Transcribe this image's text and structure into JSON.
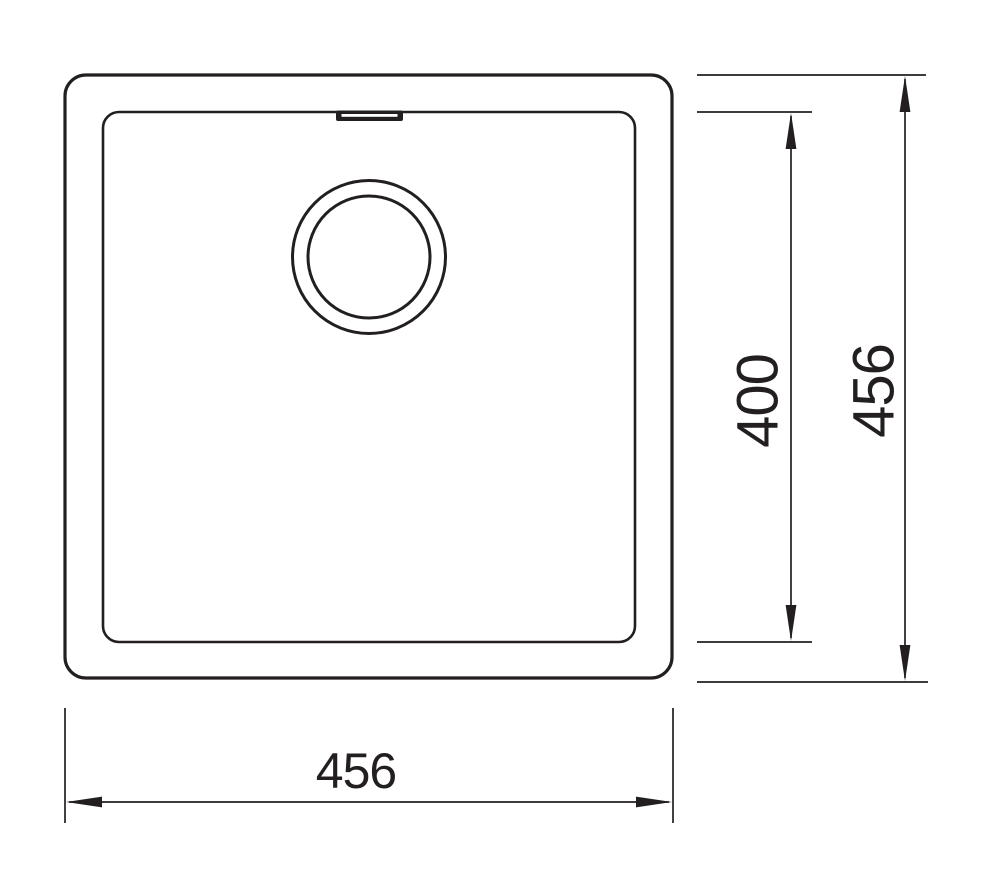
{
  "diagram": {
    "kind": "technical-drawing",
    "subject": "square-sink-top-view",
    "labels": {
      "bowl_depth": "400",
      "overall_depth": "456",
      "overall_width": "456"
    },
    "colors": {
      "line": "#231f20",
      "background": "#ffffff"
    }
  }
}
